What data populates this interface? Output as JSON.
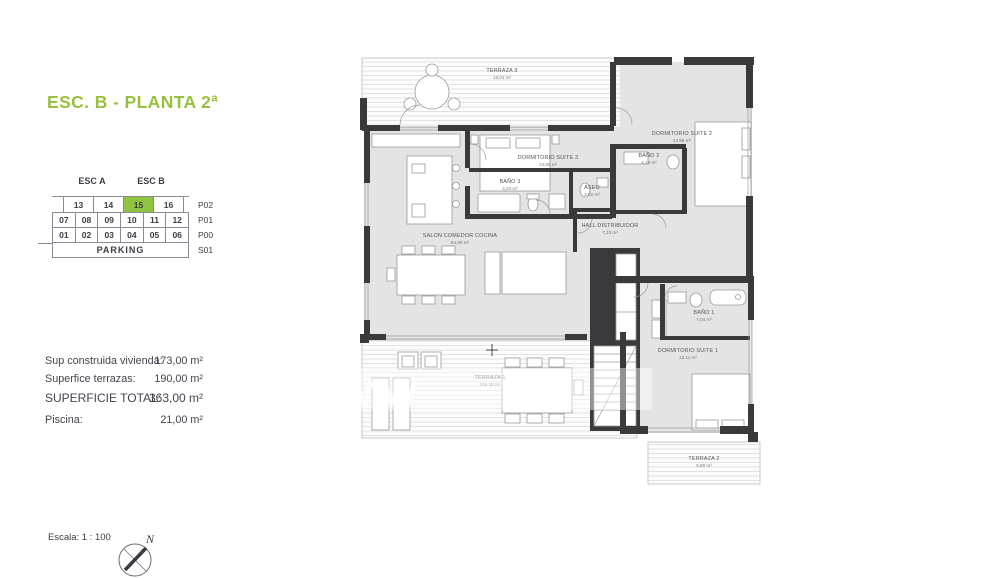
{
  "header": {
    "title": "ESC. B - PLANTA 2ª"
  },
  "selector": {
    "esc_a": "ESC A",
    "esc_b": "ESC B",
    "p02": [
      "13",
      "14",
      "15",
      "16"
    ],
    "p01": [
      "07",
      "08",
      "09",
      "10",
      "11",
      "12"
    ],
    "p00": [
      "01",
      "02",
      "03",
      "04",
      "05",
      "06"
    ],
    "parking": "PARKING",
    "floor_labels": [
      "P02",
      "P01",
      "P00",
      "S01"
    ],
    "selected_unit": "15",
    "highlight_color": "#8fc43f"
  },
  "surfaces": {
    "rows": [
      {
        "label": "Sup construida vivienda:",
        "value": "173,00 m²"
      },
      {
        "label": "Superfice terrazas:",
        "value": "190,00 m²"
      },
      {
        "label": "SUPERFICIE TOTAL:",
        "value": "363,00 m²"
      },
      {
        "label": "Piscina:",
        "value": "21,00 m²"
      }
    ]
  },
  "plan": {
    "rooms": {
      "terraza3": {
        "name": "TERRAZA 3",
        "area": "18,01 m²"
      },
      "suite3": {
        "name": "DORMITORIO SUITE 3",
        "area": "14,60 m²"
      },
      "bano3": {
        "name": "BAÑO 3",
        "area": "4,24 m²"
      },
      "aseo": {
        "name": "ASEO",
        "area": "2,02 m²"
      },
      "suite2": {
        "name": "DORMITORIO SUITE 2",
        "area": "14,98 m²"
      },
      "bano2": {
        "name": "BAÑO 2",
        "area": "4,19 m²"
      },
      "salon": {
        "name": "SALON COMEDOR COCINA",
        "area": "64,98 m²"
      },
      "hall": {
        "name": "HALL DISTRIBUIDOR",
        "area": "7,33 m²"
      },
      "bano1": {
        "name": "BAÑO 1",
        "area": "7,04 m²"
      },
      "suite1": {
        "name": "DORMITORIO SUITE 1",
        "area": "22,11 m²"
      },
      "terraza1": {
        "name": "TERRAZA 1",
        "area": "166,19 m²"
      },
      "terraza2": {
        "name": "TERRAZA 2",
        "area": "5,80 m²"
      }
    },
    "watermark": "www"
  },
  "footer": {
    "scale_label": "Escala:  1 : 100",
    "compass": "N"
  },
  "colors": {
    "accent_green": "#97c13c",
    "wall_dark": "#3a3a3c",
    "room_fill": "#e4e4e4"
  }
}
